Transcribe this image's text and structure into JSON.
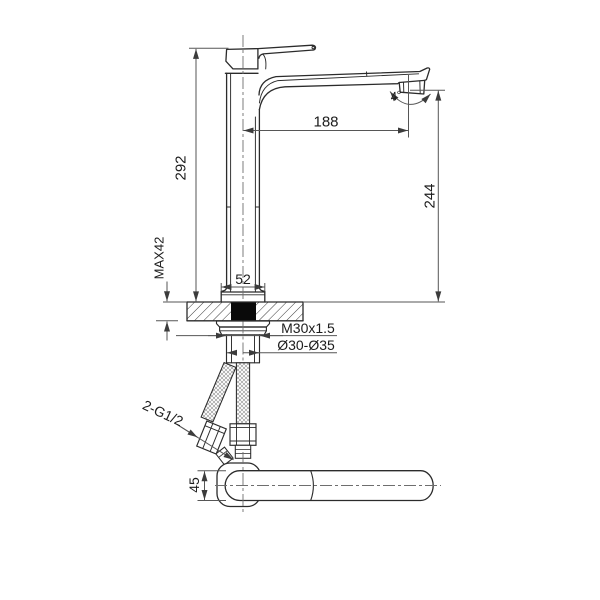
{
  "drawing": {
    "labels": {
      "overall_height": "292",
      "counter_max_thickness": "MAX42",
      "base_width": "52",
      "spout_reach": "188",
      "spout_outlet_height": "244",
      "outlet_angle": "4°",
      "mounting_thread": "M30x1.5",
      "hole_diameter_range": "Ø30-Ø35",
      "supply_hose_thread": "2-G1/2",
      "handle_width_top_view": "45"
    },
    "colors": {
      "line": "#2b2b2b",
      "dimension_line": "#565656",
      "background": "#ffffff",
      "solid_fill": "#0a0a0a"
    }
  }
}
